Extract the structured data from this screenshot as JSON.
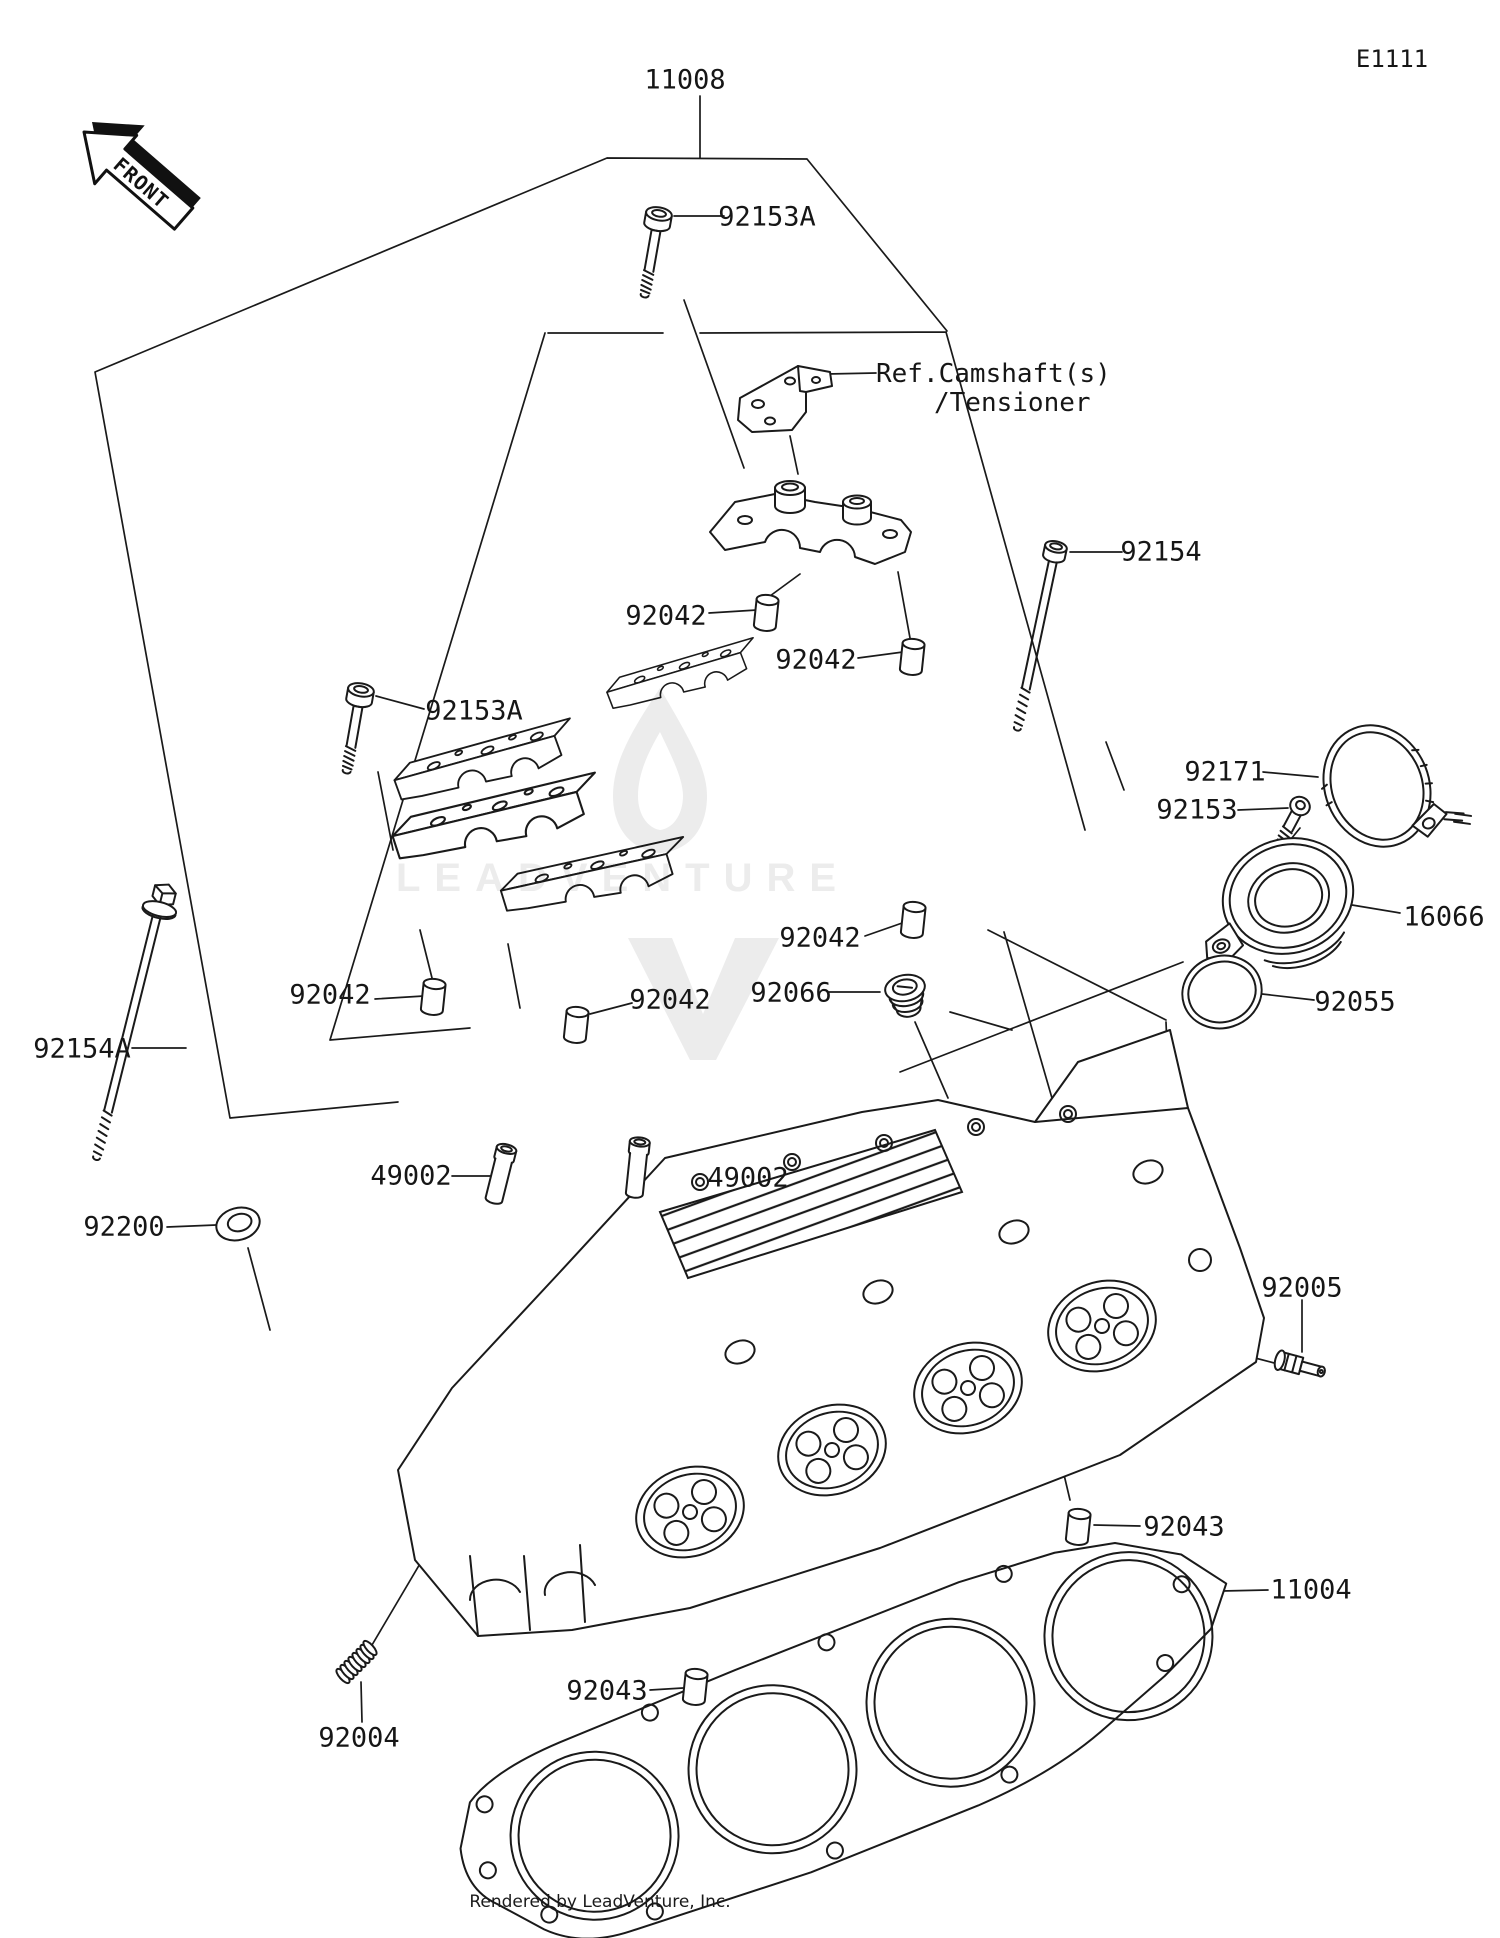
{
  "page": {
    "code": "E1111",
    "front_label": "FRONT",
    "watermark": "LEADVENTURE",
    "footer": "Rendered by LeadVenture, Inc."
  },
  "diagram": {
    "ref_note": {
      "line1": "Ref.Camshaft(s)",
      "line2": "/Tensioner"
    },
    "part_labels": [
      {
        "part": "11008",
        "x": 685,
        "y": 80
      },
      {
        "part": "92153A",
        "x": 767,
        "y": 217
      },
      {
        "part": "92154",
        "x": 1161,
        "y": 552
      },
      {
        "part": "92042",
        "x": 666,
        "y": 616
      },
      {
        "part": "92042",
        "x": 816,
        "y": 660
      },
      {
        "part": "92153A",
        "x": 474,
        "y": 711
      },
      {
        "part": "92042",
        "x": 820,
        "y": 938
      },
      {
        "part": "92042",
        "x": 330,
        "y": 995
      },
      {
        "part": "92042",
        "x": 670,
        "y": 1000
      },
      {
        "part": "92066",
        "x": 791,
        "y": 993
      },
      {
        "part": "92171",
        "x": 1225,
        "y": 772
      },
      {
        "part": "92153",
        "x": 1197,
        "y": 810
      },
      {
        "part": "16066",
        "x": 1444,
        "y": 917
      },
      {
        "part": "92055",
        "x": 1355,
        "y": 1002
      },
      {
        "part": "92154A",
        "x": 82,
        "y": 1049
      },
      {
        "part": "92200",
        "x": 124,
        "y": 1227
      },
      {
        "part": "49002",
        "x": 411,
        "y": 1176
      },
      {
        "part": "49002",
        "x": 748,
        "y": 1178
      },
      {
        "part": "92005",
        "x": 1302,
        "y": 1288
      },
      {
        "part": "92043",
        "x": 1184,
        "y": 1527
      },
      {
        "part": "11004",
        "x": 1311,
        "y": 1590
      },
      {
        "part": "92043",
        "x": 607,
        "y": 1691
      },
      {
        "part": "92004",
        "x": 359,
        "y": 1738
      }
    ]
  }
}
